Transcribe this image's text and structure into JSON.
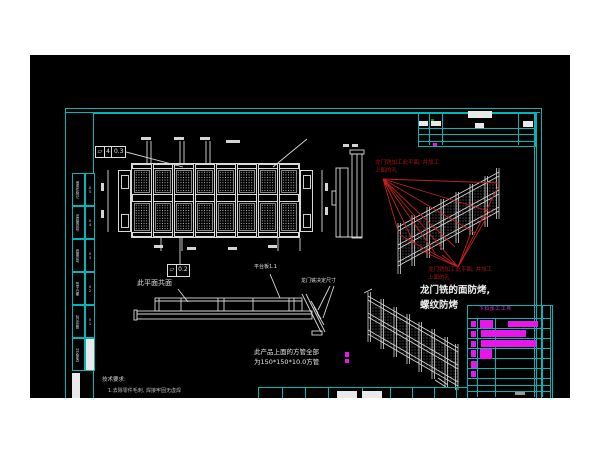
{
  "colors": {
    "frame_cyan": "#00b6b6",
    "line_white": "#e2e2e2",
    "annotation_red": "#b01616",
    "magenta": "#f32af3",
    "canvas_black": "#000000"
  },
  "notes": {
    "red_note_top_line1": "龙门铣加工此平面, 并加工",
    "red_note_top_line2": "上面的孔",
    "red_note_bottom_line1": "龙门铣加工此平面, 并加工",
    "red_note_bottom_line2": "上面的孔",
    "main_note_line1": "龙门铣的面防烤,",
    "main_note_line2": "螺纹防烤",
    "coplanar_label": "此平面共面",
    "platform_label": "平台板1.1",
    "gantry_dim_label": "龙门铣决定尺寸",
    "tube_note_line1": "此产品上面的方管全部",
    "tube_note_line2": "为150*150*10.0方管",
    "tech_req_title": "技术要求:",
    "tech_req_item": "1.去除零件毛刺, 焊接牢固无虚焊"
  },
  "fcf1": {
    "symbol": "▱",
    "count": "4",
    "tolerance": "0.3"
  },
  "fcf2": {
    "symbol": "▱",
    "tolerance": "0.2"
  },
  "left_strip": {
    "cells": [
      {
        "label": "借用件登记",
        "num": "05"
      },
      {
        "label": "旧底图总号",
        "num": "04"
      },
      {
        "label": "底图总号",
        "num": "03"
      },
      {
        "label": "签字日期",
        "num": "02"
      },
      {
        "label": "标记处数",
        "num": "01"
      },
      {
        "label": "分区更改",
        "num": ""
      }
    ]
  },
  "title_block": {
    "header": "下料加工工序"
  }
}
